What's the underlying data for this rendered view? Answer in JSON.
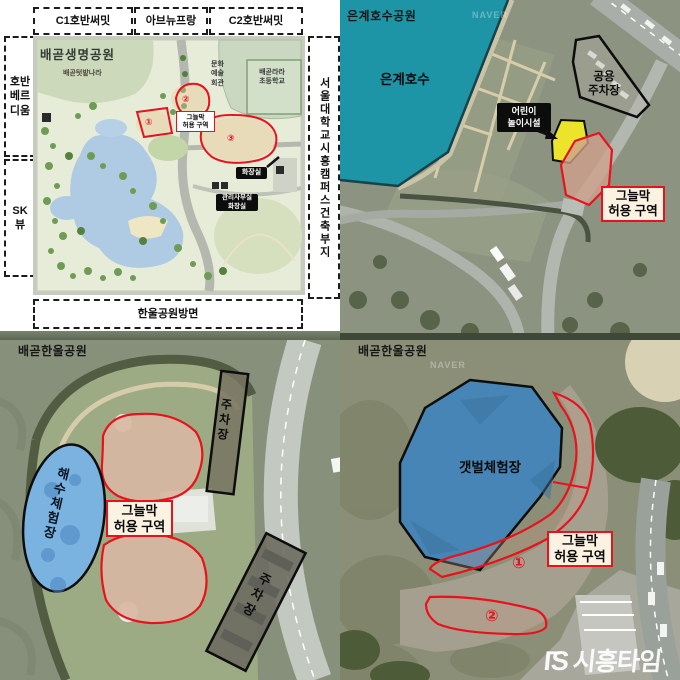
{
  "colors": {
    "accent_red": "#e8121d",
    "lake_teal": "#1e95a6",
    "pool_blue": "#7ab2e0",
    "mudflat_blue": "#4685b5",
    "zone_yellow": "#ebe42a",
    "label_cream": "#fcf2e2"
  },
  "naver_watermark": "NAVER",
  "plan": {
    "title": "배곧생명공원",
    "neighbors_top": [
      "C1호반써밋",
      "아브뉴프랑",
      "C2호반써밋"
    ],
    "neighbor_left_1": "호반\n베르\n디움",
    "neighbor_left_2": "SK\n뷰",
    "neighbor_right": "서울대학교시흥캠퍼스건축부지",
    "neighbor_bottom": "한울공원방면",
    "farm": "배곧텃밭나라",
    "culture_hall": "문화\n예술\n회관",
    "school": "배곧라라\n초등학교",
    "zone_label": "그늘막\n허용 구역",
    "markers": [
      "①",
      "②",
      "③"
    ],
    "toilet": "화장실",
    "office_toilet": "관리사무실\n화장실"
  },
  "eungye": {
    "park_name": "은계호수공원",
    "lake_name": "은계호수",
    "kids_facility": "어린이\n놀이시설",
    "public_parking": "공용\n주차장",
    "zone_label": "그늘막\n허용 구역"
  },
  "hanul_sea": {
    "park_name": "배곧한울공원",
    "sea_pool": "해수체험장",
    "parking_1": "주차장",
    "parking_2": "주차장",
    "zone_label": "그늘막\n허용 구역"
  },
  "hanul_mud": {
    "park_name": "배곧한울공원",
    "mudflat": "갯벌체험장",
    "zone_label": "그늘막\n허용 구역",
    "marker_1": "①",
    "marker_2": "②"
  },
  "watermark": {
    "mark_1": "Γ",
    "mark_2": "S",
    "brand": "시흥타임즈"
  }
}
